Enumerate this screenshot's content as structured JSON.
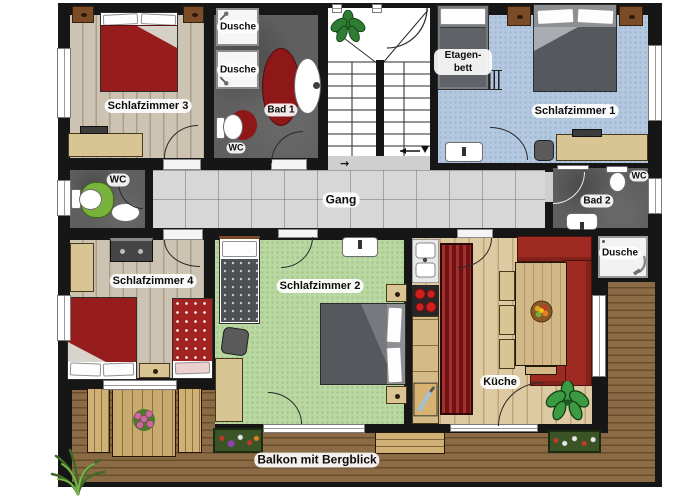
{
  "labels": {
    "schlafzimmer1": "Schlafzimmer 1",
    "schlafzimmer2": "Schlafzimmer 2",
    "schlafzimmer3": "Schlafzimmer 3",
    "schlafzimmer4": "Schlafzimmer 4",
    "dusche": "Dusche",
    "bad1": "Bad 1",
    "bad2": "Bad 2",
    "wc": "WC",
    "etagenbett_line1": "Etagen-",
    "etagenbett_line2": "bett",
    "gang": "Gang",
    "kueche": "Küche",
    "balkon": "Balkon mit Bergblick"
  },
  "icons": {
    "arrow_right": "→"
  },
  "colors": {
    "wall": "#161616",
    "bedroom_wood_floor": "#c6bcab",
    "kitchen_wood_floor": "#d8c49c",
    "balcony_deck": "#85653f",
    "carpet_blue": "#b4c9df",
    "carpet_green": "#b9d8a2",
    "bath_floor": "#5f5f5f",
    "hall_tiles": "#d7d7d7",
    "bed_red": "#971c1c",
    "sofa_red": "#9e2a22",
    "bed_gray": "#55585c",
    "furniture_tan": "#d9c493",
    "nightstand_brown": "#7c4b28",
    "wc_rug_green": "#78b43c",
    "bath_rug_red": "#8e1717",
    "stove_burner_red": "#cf2020"
  }
}
